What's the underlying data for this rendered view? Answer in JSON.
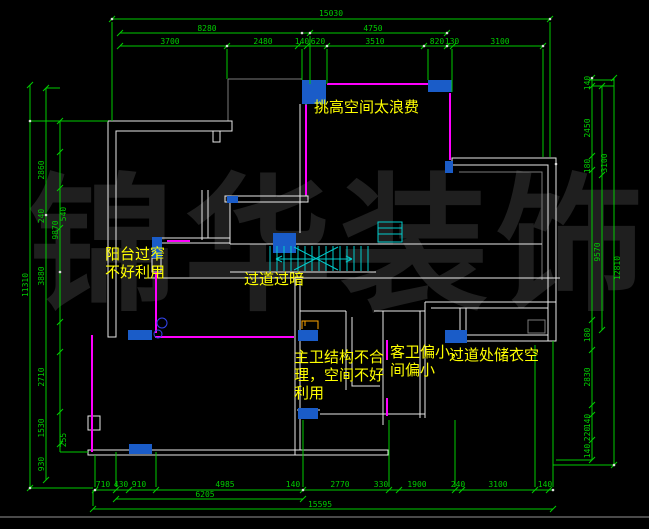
{
  "watermark": {
    "text": "锦华装饰",
    "color": "#1f1f1f"
  },
  "annotations": {
    "high_space": "挑高空间太浪费",
    "balcony": "阳台过窄\n不好利用",
    "corridor": "过道过暗",
    "master_bath": "主卫结构不合\n理，空间不好\n利用",
    "guest_bath": "客卫偏小，\n间偏小",
    "wardrobe": "过道处储衣空"
  },
  "colors": {
    "background": "#000000",
    "dimension": "#00cc00",
    "wall": "#e8e8e8",
    "outline": "#7a7a7a",
    "window": "#ff00ff",
    "column": "#1a5cc8",
    "stair": "#00cccc",
    "fixture": "#ffa500",
    "annotation": "#ffff00"
  },
  "dims": {
    "top": {
      "overall": "15030",
      "row2": [
        "8280",
        "4750"
      ],
      "row3": [
        "3700",
        "2480",
        "140",
        "620",
        "3510",
        "820",
        "130",
        "3100"
      ]
    },
    "bottom": {
      "overall": "15595",
      "sub": "6205",
      "row": [
        "710",
        "430",
        "910",
        "4985",
        "140",
        "2770",
        "330",
        "1900",
        "240",
        "3100",
        "140"
      ]
    },
    "left": {
      "overall": "11310",
      "mid": [
        "9870",
        "240"
      ],
      "inner": [
        "2860",
        "540",
        "3880",
        "2710",
        "1530",
        "255",
        "930"
      ]
    },
    "right": {
      "overall": "12810",
      "mid": [
        "3100",
        "9570"
      ],
      "inner": [
        "140",
        "2450",
        "180",
        "180",
        "2830",
        "140",
        "220",
        "140"
      ]
    }
  }
}
